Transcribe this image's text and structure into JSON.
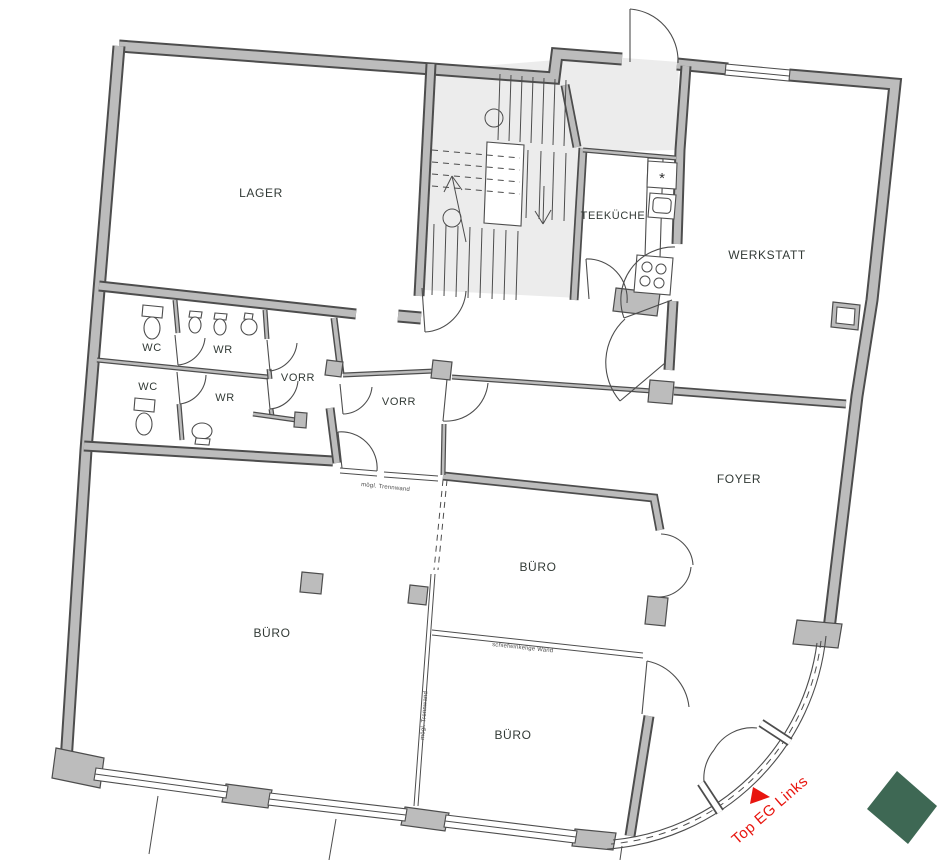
{
  "plan": {
    "rooms": {
      "lager": "LAGER",
      "teekueche": "TEEKÜCHE",
      "werkstatt": "WERKSTATT",
      "wc": "WC",
      "wr": "WR",
      "vorr": "VORR",
      "foyer": "FOYER",
      "buero": "BÜRO"
    },
    "annotations": {
      "partition_upper": "mögl. Trennwand",
      "partition_middle": "schiefwinkelige Wand",
      "partition_left": "mögl. Trennwand"
    },
    "entrance_label": "Top EG Links",
    "logo": {
      "text": "EDEX"
    },
    "colors": {
      "wall_fill": "#bcbcbc",
      "wall_outline": "#4d4d4d",
      "stair_floor": "#ececec",
      "room_label": "#323a36",
      "accent_red": "#e8150f",
      "logo_green": "#3e6854"
    }
  }
}
